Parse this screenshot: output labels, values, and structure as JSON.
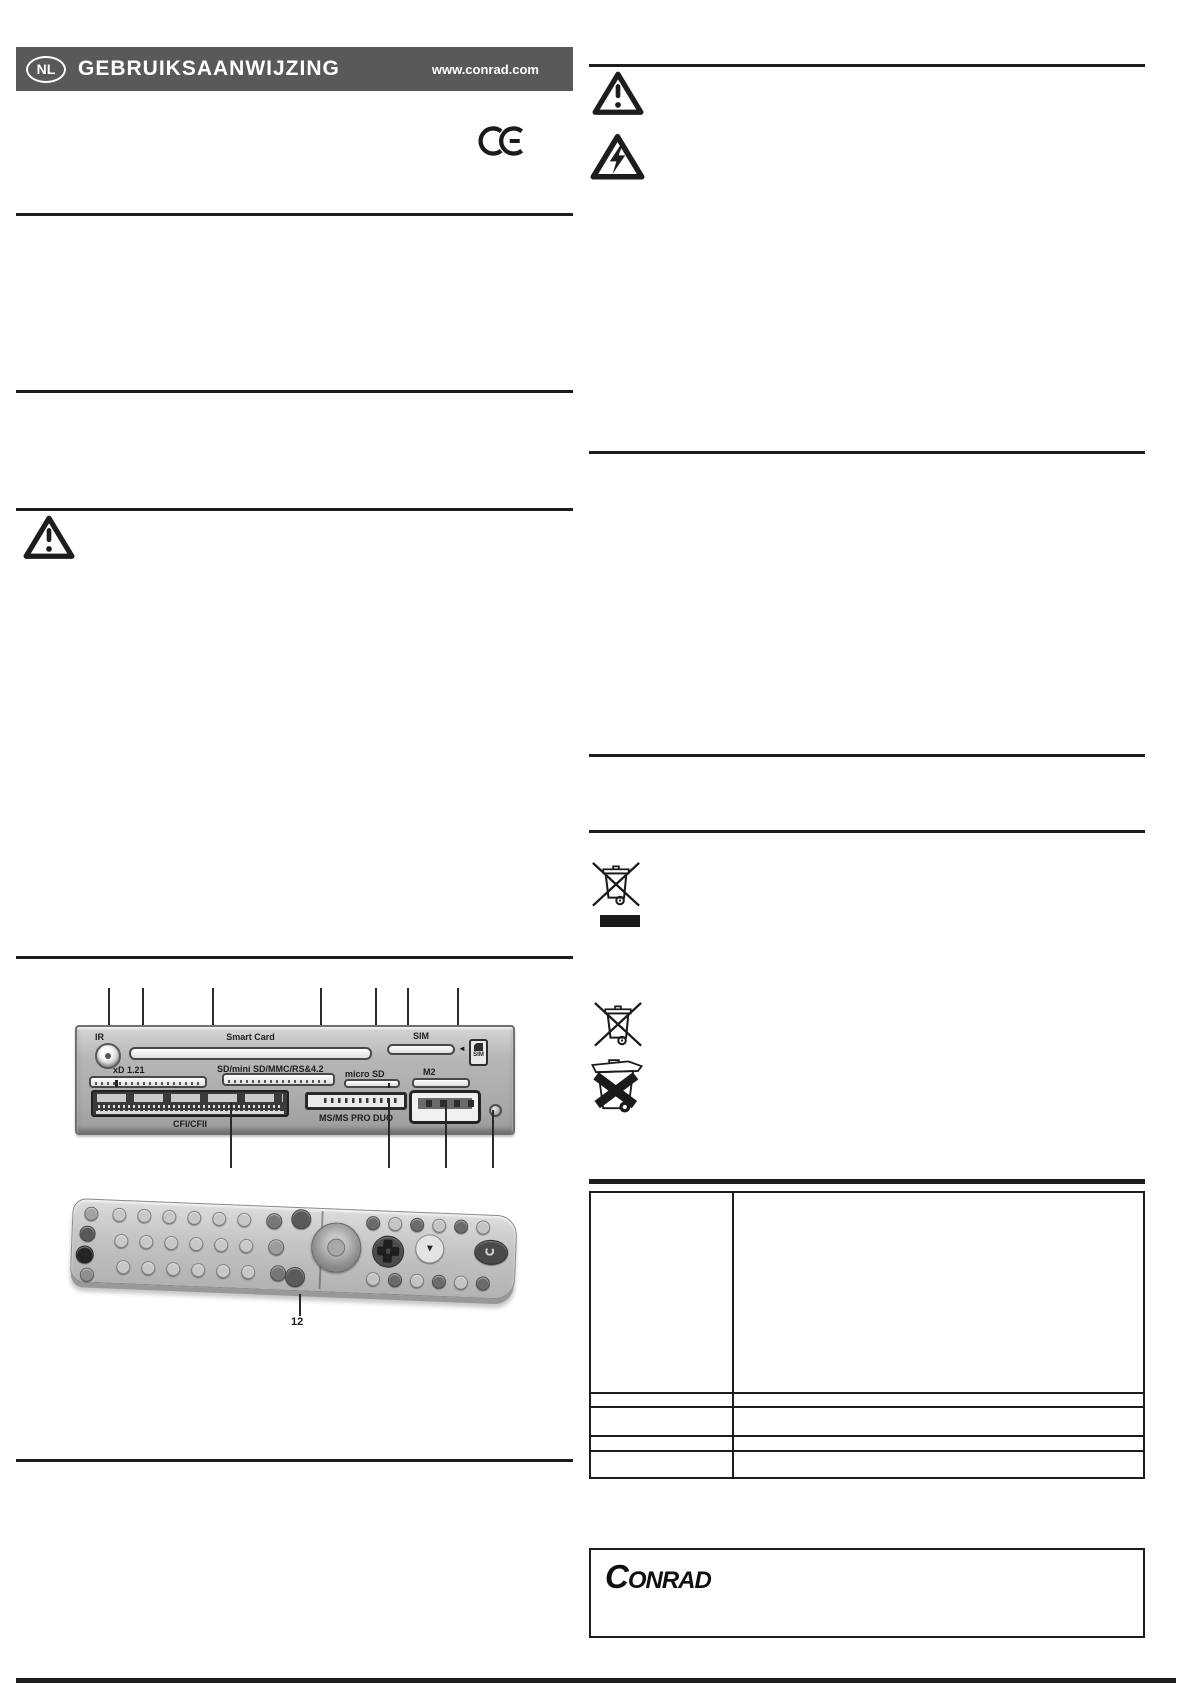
{
  "header": {
    "badge": "NL",
    "title": "GEBRUIKSAANWIJZING",
    "website": "www.conrad.com"
  },
  "icons": {
    "ce_mark": "CE",
    "warning_top": "general-warning-triangle",
    "high_voltage": "electric-shock-warning-triangle",
    "warning_left": "general-warning-triangle",
    "weee_with_bar": "crossed-out-wheelie-bin-with-black-bar",
    "weee": "crossed-out-wheelie-bin",
    "battery_disposal": "wheelie-bin-with-thick-x"
  },
  "card_reader": {
    "labels": {
      "ir": "IR",
      "smart_card": "Smart Card",
      "sim": "SIM",
      "sim_badge": "SIM",
      "sim_arrow": "◄",
      "xd": "xD 1.21",
      "sd": "SD/mini SD/MMC/RS&4.2",
      "micro_sd": "micro SD",
      "m2": "M2",
      "cf": "CFI/CFII",
      "ms": "MS/MS PRO DUO"
    }
  },
  "remote": {
    "callout": "12"
  },
  "footer": {
    "brand": "CONRAD"
  },
  "colors": {
    "header_bar": "#59595b",
    "rule_line": "#1d1d1b"
  }
}
